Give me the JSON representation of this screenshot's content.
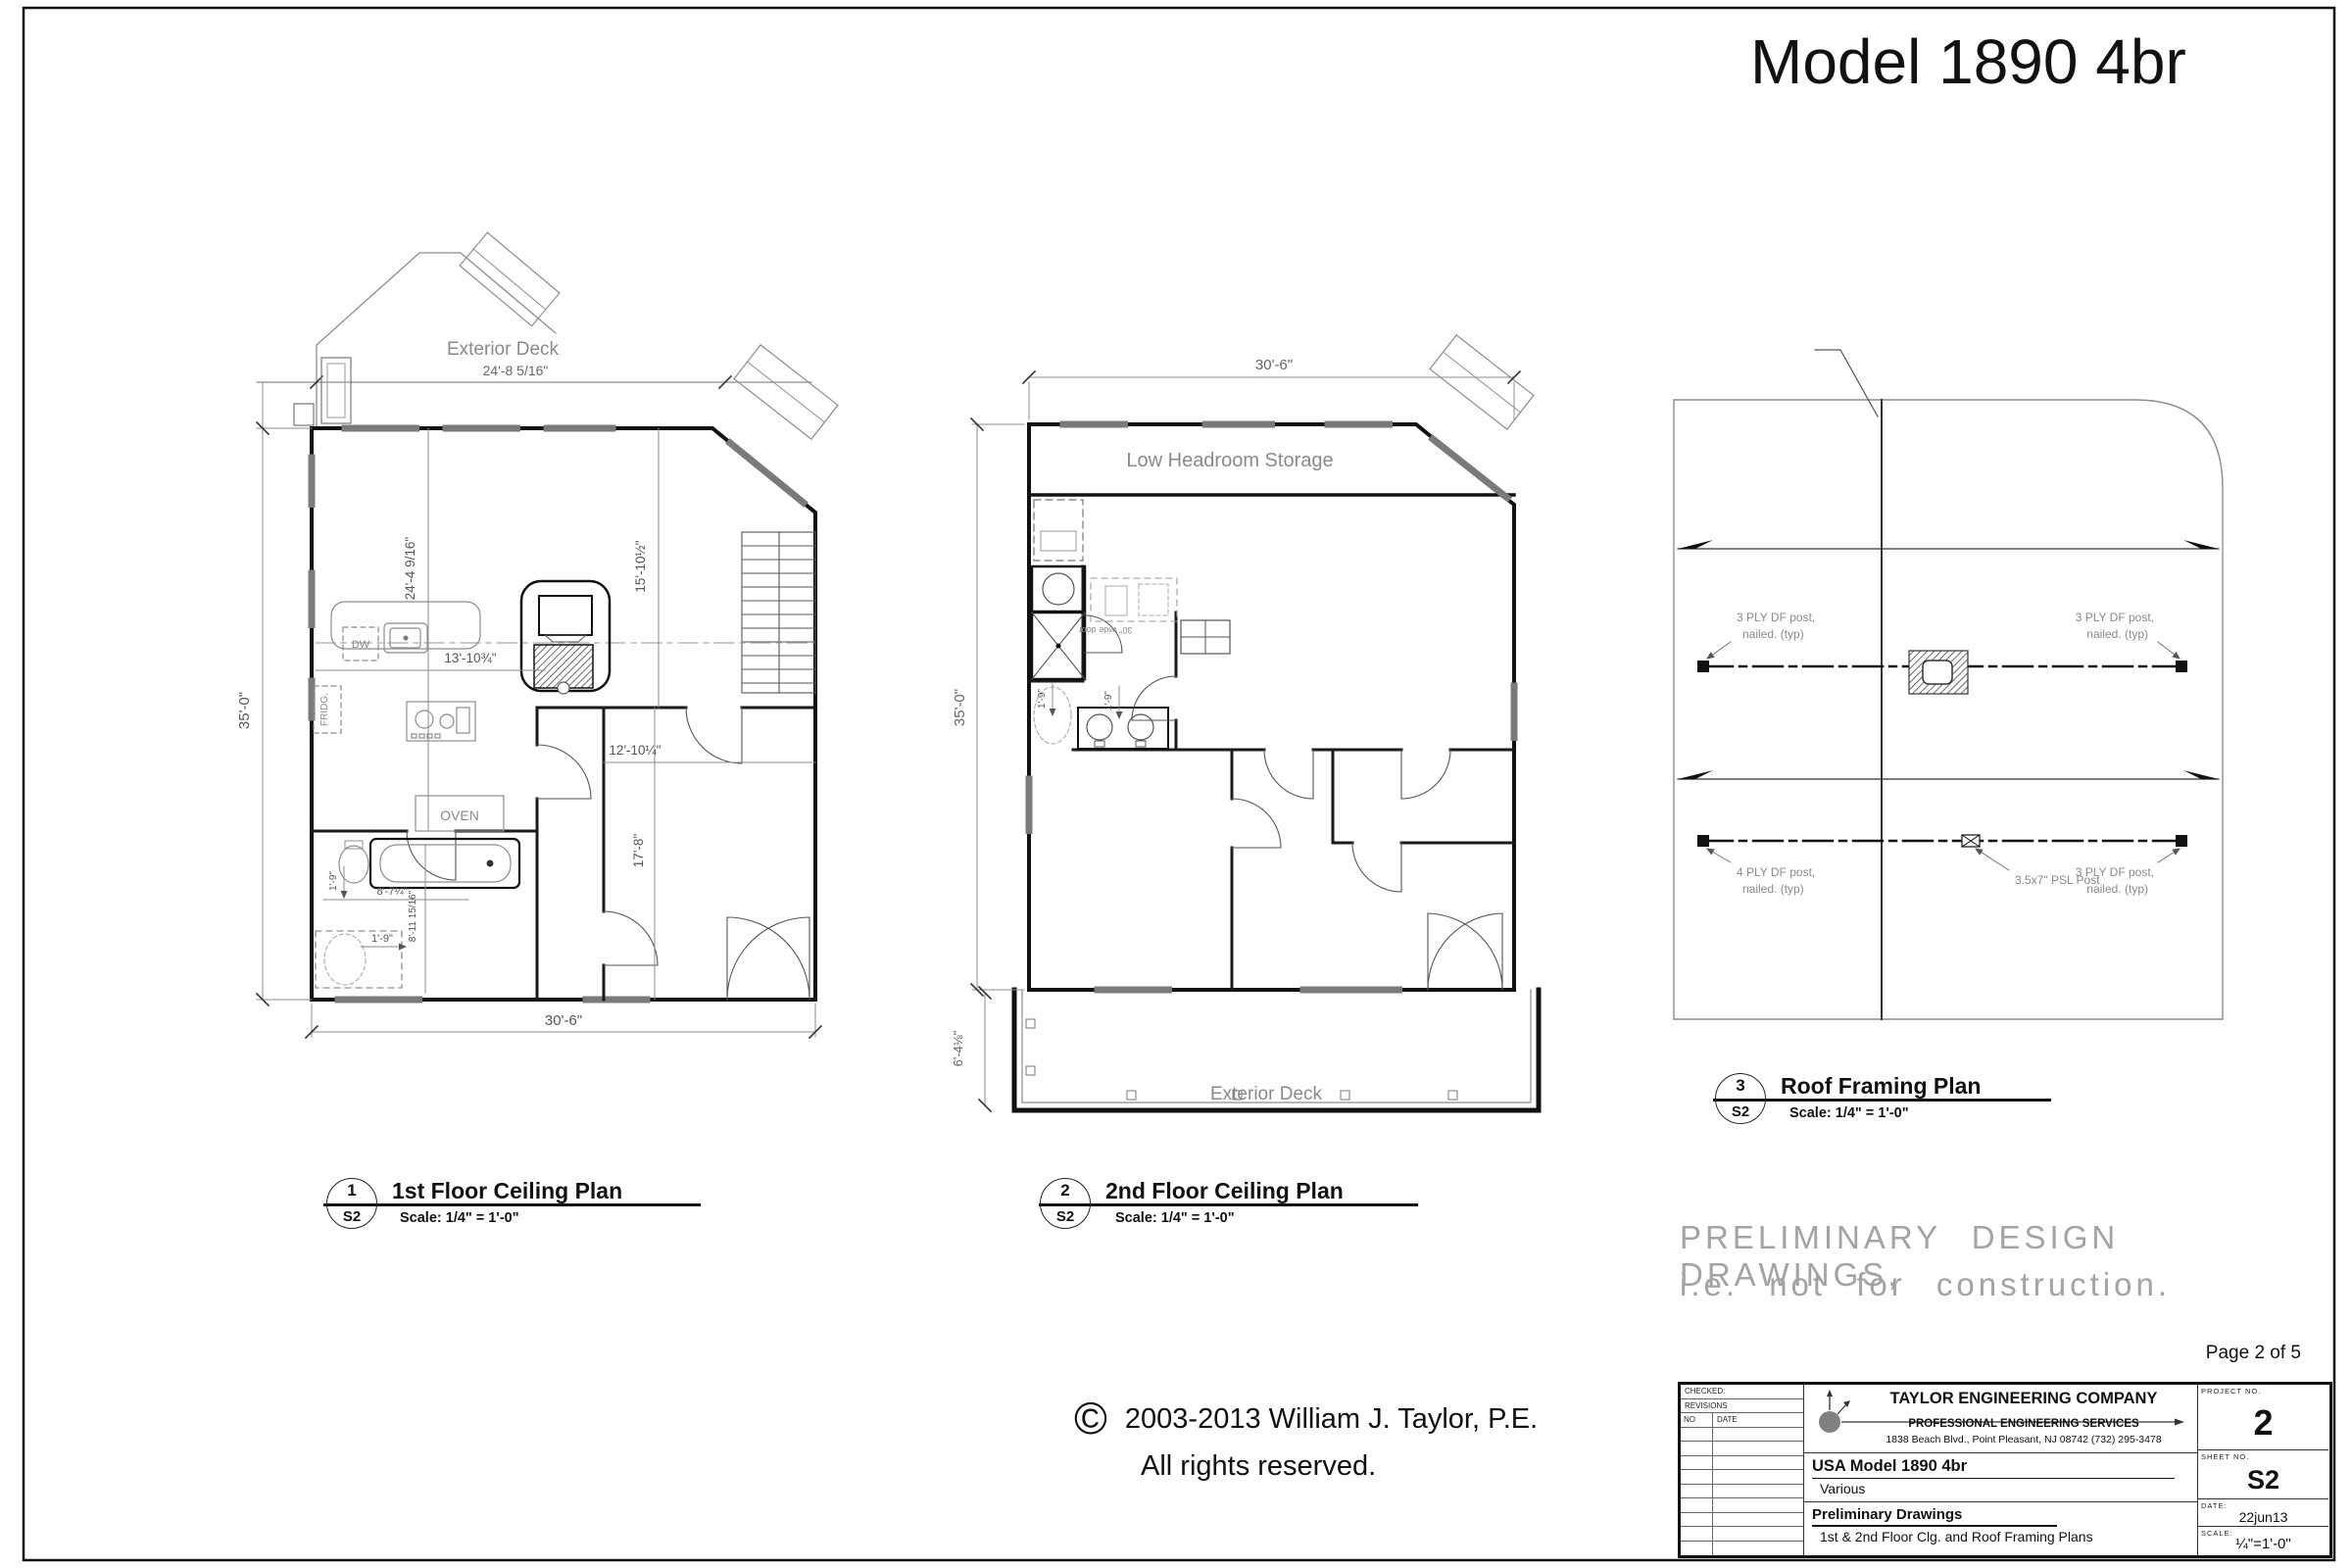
{
  "sheet": {
    "model_title": "Model 1890 4br",
    "page_label": "Page 2 of 5",
    "preliminary_line1": "PRELIMINARY DESIGN DRAWINGS,",
    "preliminary_line2": "i.e. not for construction.",
    "copyright_symbol": "©",
    "copyright_line1": "2003-2013  William J. Taylor, P.E.",
    "copyright_line2": "All rights reserved."
  },
  "plan1": {
    "num": "1",
    "ref": "S2",
    "title": "1st Floor Ceiling Plan",
    "scale": "Scale: 1/4\" = 1'-0\"",
    "deck_label": "Exterior Deck",
    "deck_dim": "24'-8 5/16\"",
    "dim_width": "30'-6\"",
    "dim_height": "35'-0\"",
    "dim_v1": "24'-4 9/16\"",
    "dim_v2": "15'-10½\"",
    "dim_h1": "13'-10¾\"",
    "dim_h2": "12'-10¼\"",
    "dim_v3": "17'-8\"",
    "dim_bath_w": "8'-7¼\"",
    "dim_bath_h": "8'-11 15/16\"",
    "dim_off1": "1'-9\"",
    "dim_off2": "1'-9\"",
    "lbl_oven": "OVEN",
    "lbl_dw": "DW",
    "lbl_fridge": "FRIDG."
  },
  "plan2": {
    "num": "2",
    "ref": "S2",
    "title": "2nd Floor Ceiling Plan",
    "scale": "Scale: 1/4\" = 1'-0\"",
    "lbl_storage": "Low Headroom Storage",
    "lbl_deck": "Exterior Deck",
    "lbl_door": "30\" wide door",
    "dim_width": "30'-6\"",
    "dim_height": "35'-0\"",
    "dim_deck": "6'-4⅛\"",
    "dim_off1": "1'-9\"",
    "dim_off2": "1'-9\""
  },
  "plan3": {
    "num": "3",
    "ref": "S2",
    "title": "Roof Framing Plan",
    "scale": "Scale: 1/4\" = 1'-0\"",
    "ann_tl1": "3 PLY DF post,",
    "ann_tl2": "nailed. (typ)",
    "ann_tr1": "3 PLY DF post,",
    "ann_tr2": "nailed. (typ)",
    "ann_bl1": "4 PLY DF post,",
    "ann_bl2": "nailed. (typ)",
    "ann_mid": "3.5x7\" PSL Post",
    "ann_br1": "3 PLY DF post,",
    "ann_br2": "nailed. (typ)"
  },
  "title_block": {
    "checked": "CHECKED:",
    "revisions": "REVISIONS",
    "no_col": "NO",
    "date_col": "DATE",
    "company": "TAYLOR ENGINEERING COMPANY",
    "services": "PROFESSIONAL ENGINEERING SERVICES",
    "address": "1838 Beach Blvd., Point Pleasant, NJ  08742  (732) 295-3478",
    "project_label": "PROJECT  NO.",
    "project_no": "2",
    "model": "USA Model 1890 4br",
    "series": "Various",
    "sheet_label": "SHEET  NO.",
    "sheet_no": "S2",
    "drawing_type": "Preliminary Drawings",
    "sheet_title": "1st & 2nd Floor Clg. and Roof Framing Plans",
    "date_label": "DATE:",
    "date": "22jun13",
    "scale_label": "SCALE:",
    "scale": "¼\"=1'-0\""
  }
}
